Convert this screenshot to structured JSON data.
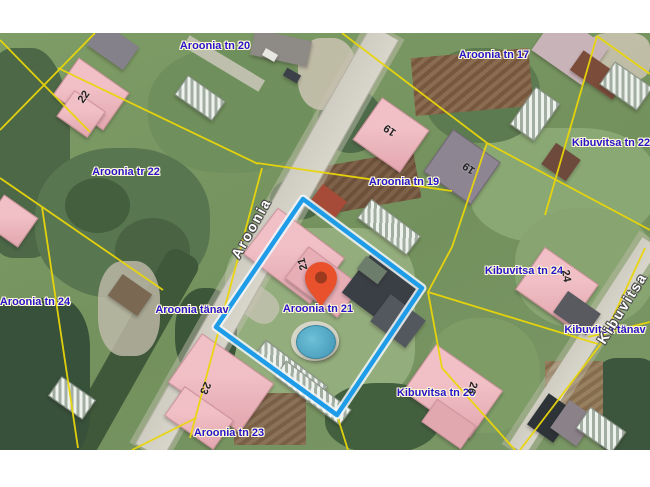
{
  "map": {
    "selected_parcel": {
      "address": "Aroonia tn 21"
    },
    "colors": {
      "parcel_line": "#ead609",
      "selection_outline": "#1f9ce8",
      "selection_halo": "#f2f7f9",
      "pin": "#e8512b",
      "pin_hole": "#9c3a20",
      "address_text": "#2815c9",
      "street_text": "#ffffff"
    },
    "address_labels": [
      {
        "id": "aroonia-tn-20",
        "text": "Aroonia tn 20",
        "x": 215,
        "y": 46
      },
      {
        "id": "aroonia-tn-17",
        "text": "Aroonia tn 17",
        "x": 494,
        "y": 55
      },
      {
        "id": "aroonia-tr-22",
        "text": "Aroonia tr 22",
        "x": 126,
        "y": 172
      },
      {
        "id": "kibuvitsa-tn-22",
        "text": "Kibuvitsa tn 22",
        "x": 611,
        "y": 143
      },
      {
        "id": "aroonia-tn-19",
        "text": "Aroonia tn 19",
        "x": 404,
        "y": 182
      },
      {
        "id": "aroonia-tn-24",
        "text": "Aroonia tn 24",
        "x": 35,
        "y": 302
      },
      {
        "id": "aroonia-tanav",
        "text": "Aroonia tänav",
        "x": 192,
        "y": 310
      },
      {
        "id": "aroonia-tn-21",
        "text": "Aroonia tn 21",
        "x": 318,
        "y": 309
      },
      {
        "id": "kibuvitsa-tn-24",
        "text": "Kibuvitsa tn 24",
        "x": 524,
        "y": 271
      },
      {
        "id": "kibuvitsa-tanav",
        "text": "Kibuvitsa tänav",
        "x": 605,
        "y": 330
      },
      {
        "id": "kibuvitsa-tn-26",
        "text": "Kibuvitsa tn 26",
        "x": 436,
        "y": 393
      },
      {
        "id": "aroonia-tn-23",
        "text": "Aroonia tn 23",
        "x": 229,
        "y": 433
      }
    ],
    "street_names": [
      {
        "id": "aroonia-street",
        "text": "Aroonia",
        "x": 251,
        "y": 228,
        "rotation": -61
      },
      {
        "id": "kibuvitsa-street",
        "text": "Kibuvitsa",
        "x": 622,
        "y": 308,
        "rotation": -58
      }
    ],
    "building_numbers": [
      {
        "text": "22",
        "x": 84,
        "y": 97,
        "rotation": -55
      },
      {
        "text": "19",
        "x": 390,
        "y": 130,
        "rotation": 215
      },
      {
        "text": "19",
        "x": 469,
        "y": 168,
        "rotation": 215
      },
      {
        "text": "21",
        "x": 303,
        "y": 264,
        "rotation": -105
      },
      {
        "text": "24",
        "x": 566,
        "y": 276,
        "rotation": 80
      },
      {
        "text": "26",
        "x": 472,
        "y": 388,
        "rotation": 105
      },
      {
        "text": "23",
        "x": 205,
        "y": 388,
        "rotation": 115
      }
    ]
  }
}
